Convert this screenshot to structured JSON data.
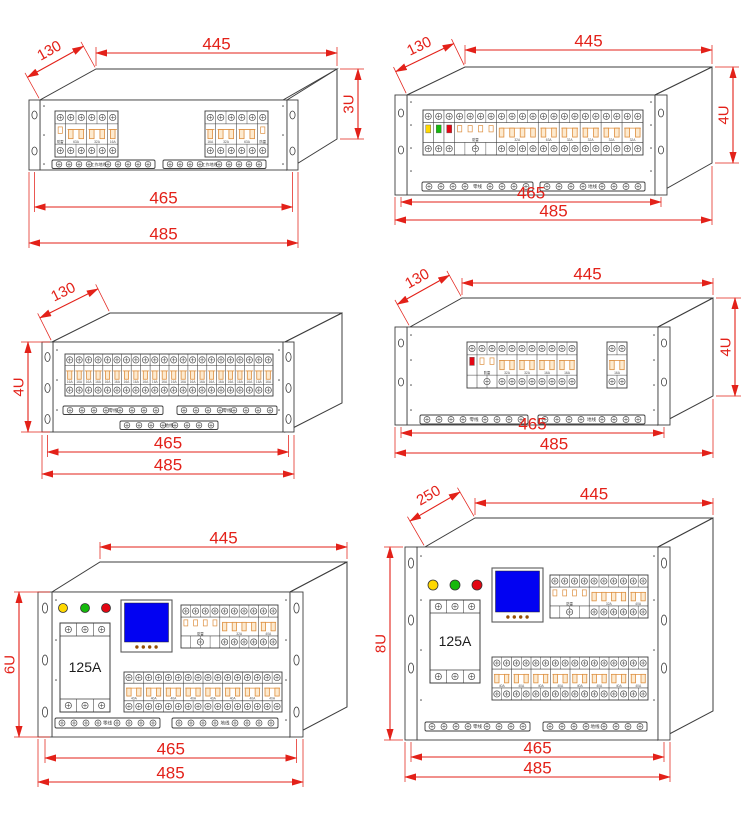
{
  "colors": {
    "dimension_red": "#e32119",
    "outline": "#3d3d3d",
    "breaker_orange": "#dd8f3f",
    "breaker_fill": "#fdeacf",
    "screw": "#4c4c4c",
    "lcd_blue": "#0202f2",
    "lcd_button_brown": "#944f05",
    "lamp_yellow": "#ffd800",
    "lamp_green": "#15b90c",
    "lamp_red": "#e30613"
  },
  "units": [
    {
      "id": "unit-3u",
      "dims": {
        "depth": "130",
        "width": "445",
        "height": "3U",
        "inner_width": "465",
        "outer_width": "485"
      },
      "groups": [
        {
          "sections": [
            {
              "span": 1,
              "type": "spd",
              "label": "防雷"
            },
            {
              "span": 2,
              "type": "breaker",
              "label": "63A"
            },
            {
              "span": 2,
              "type": "breaker",
              "label": "32A"
            },
            {
              "span": 1,
              "type": "breaker",
              "label": "16A"
            }
          ]
        },
        {
          "sections": [
            {
              "span": 1,
              "type": "breaker",
              "label": "16A"
            },
            {
              "span": 2,
              "type": "breaker",
              "label": "32A"
            },
            {
              "span": 2,
              "type": "breaker",
              "label": "63A"
            },
            {
              "span": 1,
              "type": "spd",
              "label": "防雷"
            }
          ]
        }
      ],
      "strips": [
        {
          "label": "工作地线"
        },
        {
          "label": "工作地线"
        }
      ]
    },
    {
      "id": "unit-4u-long",
      "dims": {
        "depth": "130",
        "width": "445",
        "height": "4U",
        "inner_width": "465",
        "outer_width": "485"
      },
      "panel": {
        "sections": [
          {
            "span": 1,
            "type": "indicator",
            "color": "#ffd800"
          },
          {
            "span": 1,
            "type": "indicator",
            "color": "#15b90c"
          },
          {
            "span": 1,
            "type": "indicator",
            "color": "#e30613"
          },
          {
            "span": 4,
            "type": "spd",
            "label": "防雷"
          },
          {
            "span": 4,
            "type": "breaker",
            "label": "32A"
          },
          {
            "span": 2,
            "type": "breaker",
            "label": "63A"
          },
          {
            "span": 2,
            "type": "breaker",
            "label": "32A"
          },
          {
            "span": 2,
            "type": "breaker",
            "label": "32A"
          },
          {
            "span": 2,
            "type": "breaker",
            "label": "32A"
          },
          {
            "span": 2,
            "type": "breaker",
            "label": "32A"
          }
        ]
      },
      "strips": [
        {
          "label": "零线"
        },
        {
          "label": "地线"
        }
      ]
    },
    {
      "id": "unit-4u-row",
      "dims": {
        "depth": "130",
        "height": "4U",
        "inner_width": "465",
        "outer_width": "485"
      },
      "row": {
        "count": 22,
        "label": "16A"
      },
      "strips": [
        {
          "label": "零线"
        },
        {
          "label": "零线"
        },
        {
          "label": "地线"
        }
      ]
    },
    {
      "id": "unit-4u-split",
      "dims": {
        "depth": "130",
        "width": "445",
        "height": "4U",
        "inner_width": "465",
        "outer_width": "485"
      },
      "panel": {
        "sections": [
          {
            "span": 1,
            "type": "indicator",
            "color": "#e30613",
            "noBottom": true
          },
          {
            "span": 2,
            "type": "spd",
            "label": "防雷"
          },
          {
            "span": 2,
            "type": "breaker",
            "label": "32A"
          },
          {
            "span": 2,
            "type": "breaker",
            "label": "32A"
          },
          {
            "span": 2,
            "type": "breaker",
            "label": "16A"
          },
          {
            "span": 2,
            "type": "breaker",
            "label": "16A"
          }
        ]
      },
      "aux_breaker": {
        "label": "16A"
      },
      "strips": [
        {
          "label": "零线"
        },
        {
          "label": "地线"
        }
      ]
    },
    {
      "id": "unit-6u",
      "dims": {
        "width": "445",
        "height": "6U",
        "inner_width": "465",
        "outer_width": "485"
      },
      "main_breaker": "125A",
      "panel": {
        "sections": [
          {
            "span": 4,
            "type": "spd",
            "label": "防雷"
          },
          {
            "span": 4,
            "type": "breaker",
            "label": "32A"
          },
          {
            "span": 2,
            "type": "breaker",
            "label": "40A"
          }
        ]
      },
      "row": {
        "count": 8,
        "label": "40A"
      },
      "strips": [
        {
          "label": "零线"
        },
        {
          "label": "地线"
        }
      ]
    },
    {
      "id": "unit-8u",
      "dims": {
        "depth": "250",
        "width": "445",
        "height": "8U",
        "inner_width": "465",
        "outer_width": "485"
      },
      "main_breaker": "125A",
      "panel": {
        "sections": [
          {
            "span": 4,
            "type": "spd",
            "label": "防雷"
          },
          {
            "span": 4,
            "type": "breaker",
            "label": "32A"
          },
          {
            "span": 2,
            "type": "breaker",
            "label": "40A"
          }
        ]
      },
      "row": {
        "count": 8,
        "label": "40A"
      },
      "strips": [
        {
          "label": "零线"
        },
        {
          "label": "地线"
        }
      ]
    }
  ]
}
